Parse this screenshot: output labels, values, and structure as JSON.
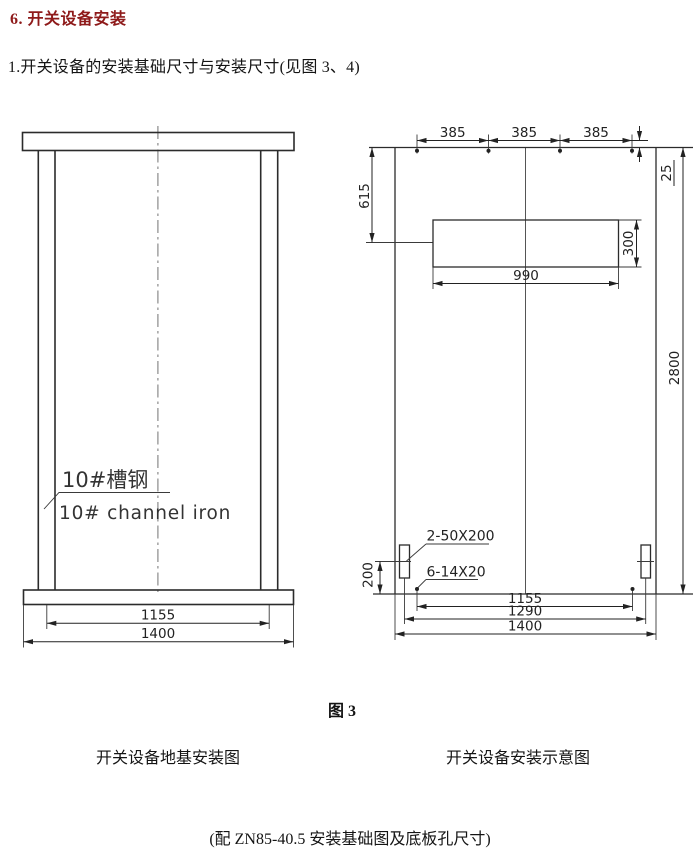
{
  "page": {
    "heading": "6. 开关设备安装",
    "intro": "1.开关设备的安装基础尺寸与安装尺寸(见图 3、4)",
    "figure_label": "图 3",
    "caption_left": "开关设备地基安装图",
    "caption_right": "开关设备安装示意图",
    "footnote": "(配 ZN85-40.5  安装基础图及底板孔尺寸)",
    "colors": {
      "heading": "#8e1a1a",
      "line": "#2b2b2b",
      "centerline": "#8a8a8a"
    }
  },
  "foundation_view": {
    "channel_label_cn": "10#槽钢",
    "channel_label_en": "10# channel iron",
    "dims": {
      "channel_centers": "1155",
      "overall_width": "1400"
    }
  },
  "plan_view": {
    "dims": {
      "hole_pitch": [
        "385",
        "385",
        "385"
      ],
      "edge_to_hole": "25",
      "top_to_window_center": "615",
      "window_height": "300",
      "window_width": "990",
      "overall_height": "2800",
      "slot_to_edge": "200",
      "hole_span": "1155",
      "slot_span": "1290",
      "overall_width": "1400"
    },
    "notes": {
      "slots": "2-50X200",
      "holes": "6-14X20"
    }
  }
}
